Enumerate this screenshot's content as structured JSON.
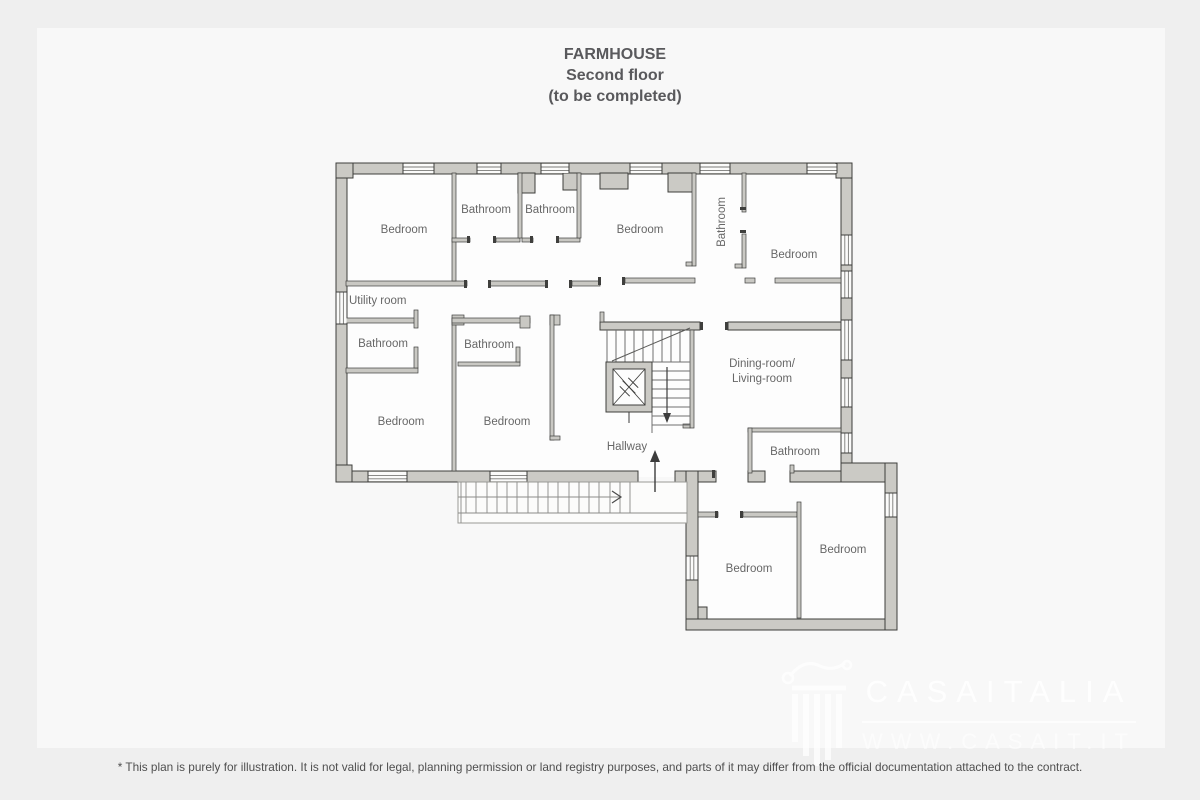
{
  "title": {
    "line1": "FARMHOUSE",
    "line2": "Second floor",
    "line3": "(to be completed)"
  },
  "rooms": [
    {
      "id": "bedroom-1",
      "label": "Bedroom"
    },
    {
      "id": "bathroom-1",
      "label": "Bathroom"
    },
    {
      "id": "bathroom-2",
      "label": "Bathroom"
    },
    {
      "id": "bedroom-2",
      "label": "Bedroom"
    },
    {
      "id": "bathroom-3",
      "label": "Bathroom"
    },
    {
      "id": "bedroom-3",
      "label": "Bedroom"
    },
    {
      "id": "utility-room",
      "label": "Utility room"
    },
    {
      "id": "bathroom-4",
      "label": "Bathroom"
    },
    {
      "id": "bathroom-5",
      "label": "Bathroom"
    },
    {
      "id": "bedroom-4",
      "label": "Bedroom"
    },
    {
      "id": "bedroom-5",
      "label": "Bedroom"
    },
    {
      "id": "dining-living",
      "label": "Dining-room/",
      "label2": "Living-room"
    },
    {
      "id": "hallway",
      "label": "Hallway"
    },
    {
      "id": "bathroom-6",
      "label": "Bathroom"
    },
    {
      "id": "bedroom-6",
      "label": "Bedroom"
    },
    {
      "id": "bedroom-7",
      "label": "Bedroom"
    }
  ],
  "watermark": {
    "brand": "CASAITALIA",
    "url": "WWW.CASAIT.IT"
  },
  "footer": {
    "disclaimer": "* This plan is purely for illustration. It is not valid for legal, planning permission or land registry purposes, and parts of it may differ from the official documentation attached to the contract."
  },
  "colors": {
    "background_outer": "#efefef",
    "background_inner": "#f8f8f8",
    "wall_fill": "#cbcac5",
    "wall_outline": "#3e3e3c",
    "room_floor": "#fdfdfd",
    "label_text": "#676767",
    "title_text": "#59595c",
    "watermark": "#ffffff"
  }
}
